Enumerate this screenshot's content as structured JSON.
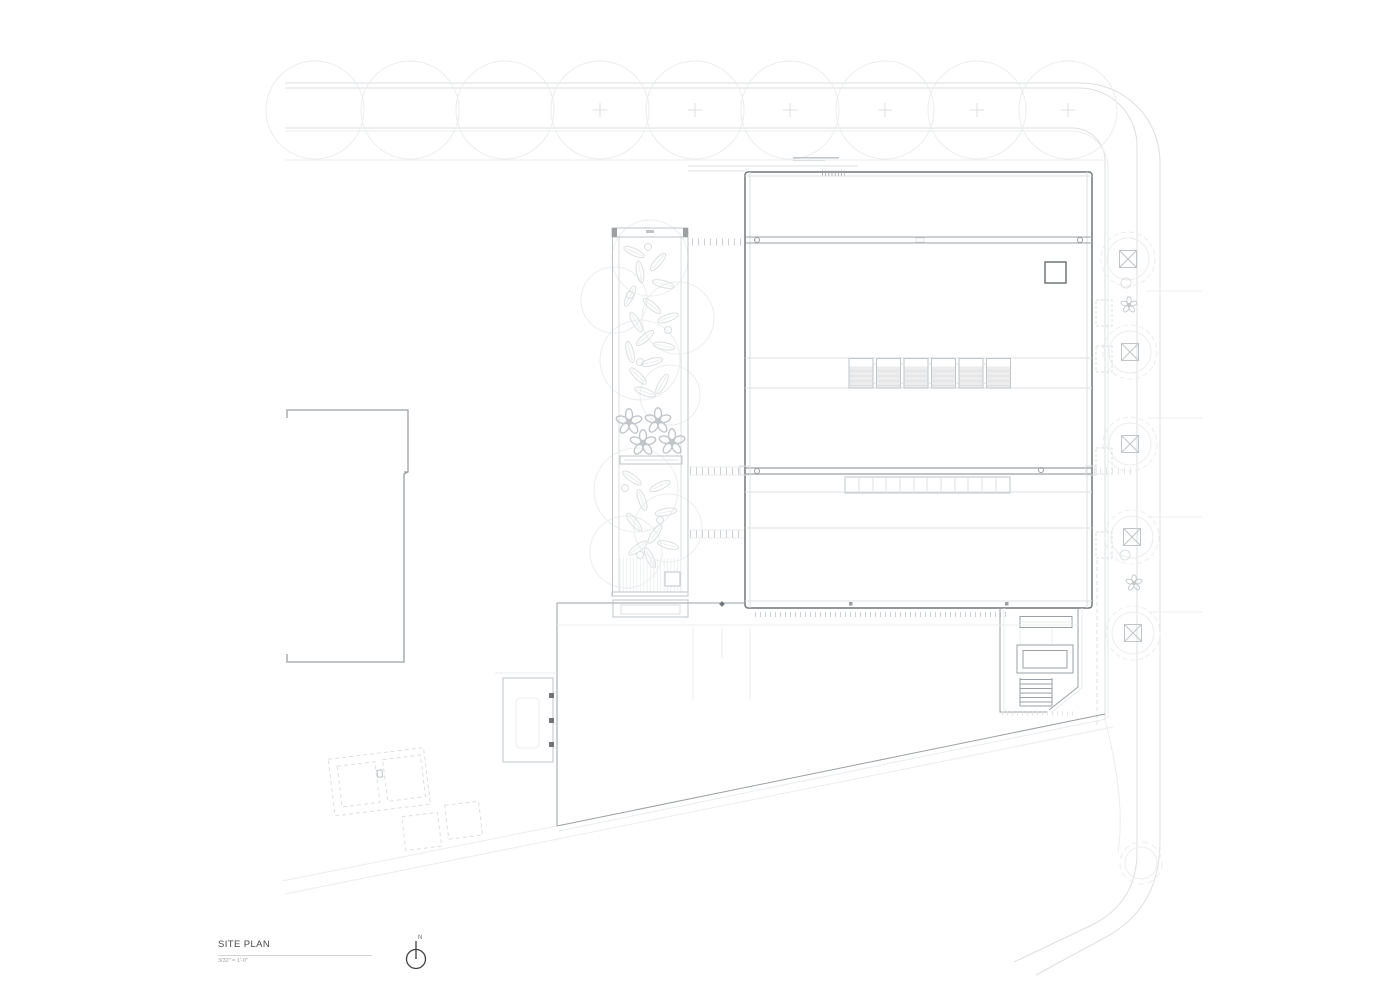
{
  "sheet": {
    "title": "SITE PLAN",
    "scale_label": "3/32\" = 1'-0\"",
    "north_label": "N"
  },
  "colors": {
    "paper": "#ffffff",
    "ink-strong": "#70767a",
    "ink-medium": "#9aa0a4",
    "ink-light": "#bfc5c9",
    "ink-faint": "#dcdfe1",
    "ink-ghost": "#ebedee",
    "text-dark": "#4b4b4b",
    "text-light": "#a2a2a2",
    "hatch-fill": "#ededee",
    "accent-dark": "#6e7478"
  }
}
